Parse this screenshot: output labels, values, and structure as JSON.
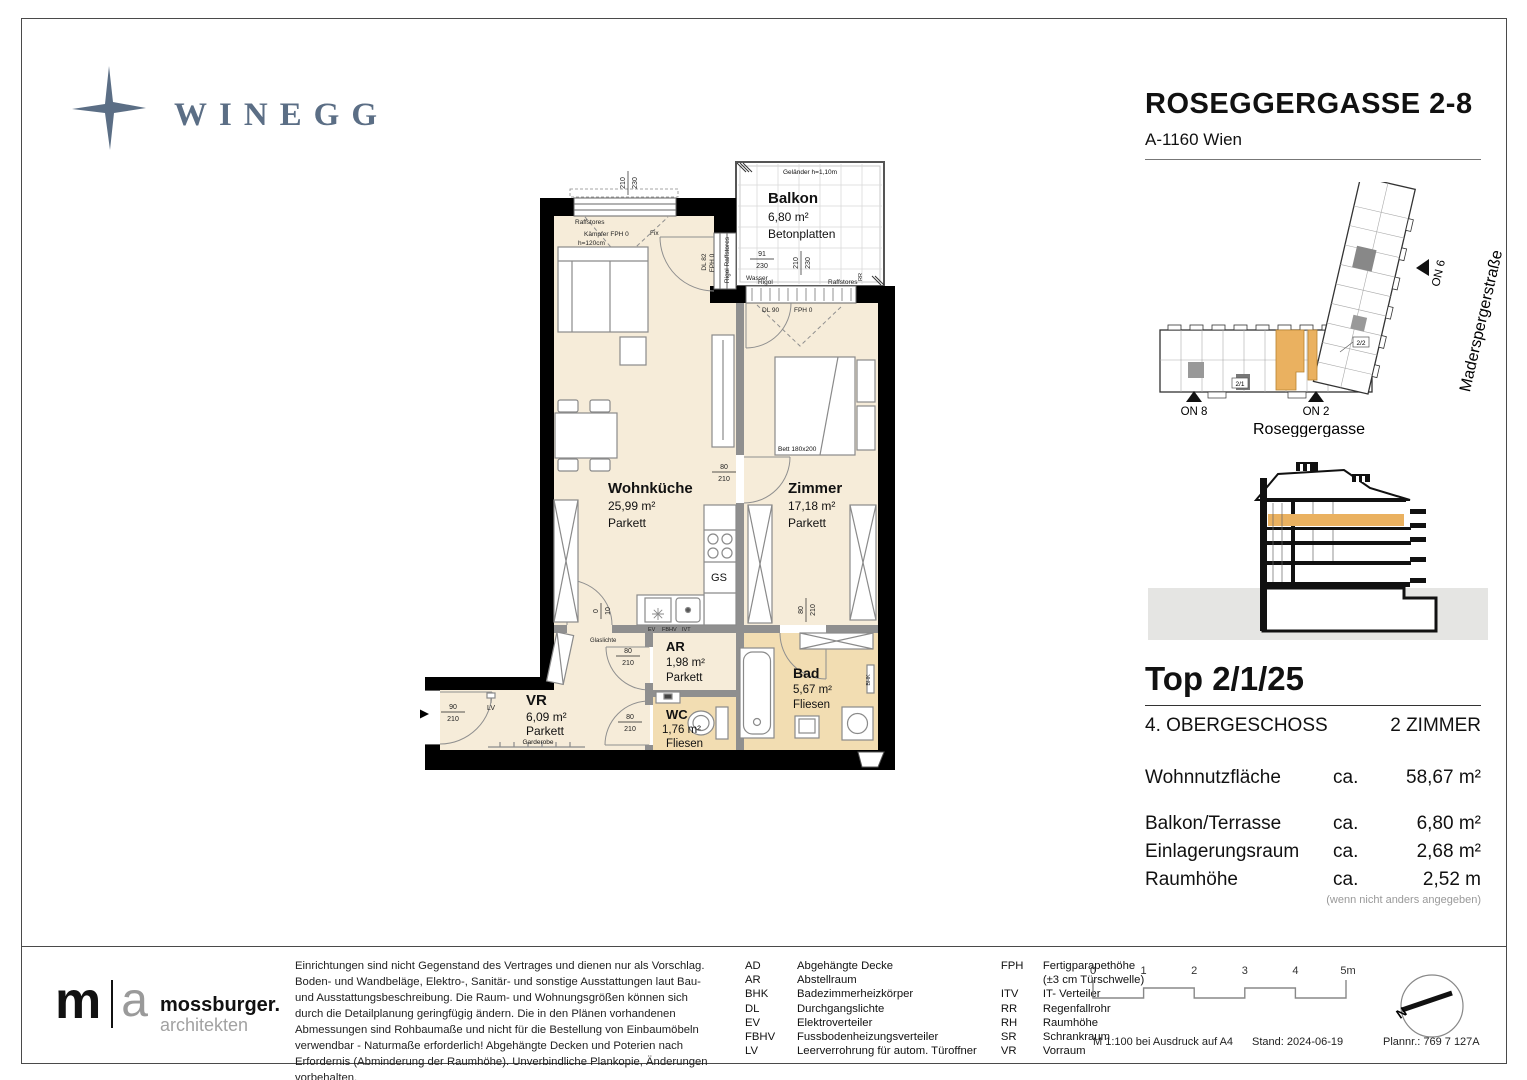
{
  "page": {
    "brand": "WINEGG",
    "title": "ROSEGGERGASSE 2-8",
    "subtitle": "A-1160 Wien"
  },
  "plan": {
    "rooms": {
      "balkon": {
        "name": "Balkon",
        "area": "6,80 m²",
        "floor": "Betonplatten",
        "railing": "Geländer h=1,10m"
      },
      "wohnkueche": {
        "name": "Wohnküche",
        "area": "25,99 m²",
        "floor": "Parkett"
      },
      "zimmer": {
        "name": "Zimmer",
        "area": "17,18 m²",
        "floor": "Parkett",
        "bed": "Bett 180x200"
      },
      "ar": {
        "name": "AR",
        "area": "1,98 m²",
        "floor": "Parkett"
      },
      "vr": {
        "name": "VR",
        "area": "6,09 m²",
        "floor": "Parkett",
        "wardrobe": "Garderobe"
      },
      "wc": {
        "name": "WC",
        "area": "1,76 m²",
        "floor": "Fliesen"
      },
      "bad": {
        "name": "Bad",
        "area": "5,67 m²",
        "floor": "Fliesen"
      }
    },
    "labels": {
      "unit": "2/1/25",
      "raffstores": "Raffstores",
      "kaempfer": "Kämpfer FPH 0",
      "h120": "h=120cm",
      "fix": "Fix",
      "dl82": "DL 82",
      "fph0": "FPH 0",
      "rigol_raffstores": "Rigol Raffstores",
      "wasser": "Wasser",
      "rigol": "Rigol",
      "dl90": "DL 90",
      "rr": "RR",
      "gs": "GS",
      "bhk": "BHK",
      "lv": "LV",
      "ev": "EV",
      "fbhv": "FBHV",
      "ivt": "IVT",
      "glaslichte": "Glaslichte"
    },
    "dims": {
      "v210": "210",
      "v230": "230",
      "v91": "91",
      "v80": "80",
      "v90": "90",
      "v0": "0",
      "v10": "10"
    }
  },
  "site": {
    "streets": {
      "roseggergasse": "Roseggergasse",
      "madersperger": "Maderspergerstraße"
    },
    "entrances": {
      "on8": "ON 8",
      "on2": "ON 2",
      "on6": "ON 6"
    },
    "units": {
      "u21": "2/1",
      "u22": "2/2"
    },
    "highlight_color": "#eab160"
  },
  "info": {
    "top": "Top 2/1/25",
    "floor": "4. OBERGESCHOSS",
    "rooms": "2 ZIMMER",
    "metrics": [
      {
        "label": "Wohnnutzfläche",
        "ca": "ca.",
        "value": "58,67 m²"
      },
      {
        "label": "Balkon/Terrasse",
        "ca": "ca.",
        "value": "6,80 m²"
      },
      {
        "label": "Einlagerungsraum",
        "ca": "ca.",
        "value": "2,68 m²"
      },
      {
        "label": "Raumhöhe",
        "ca": "ca.",
        "value": "2,52 m"
      }
    ],
    "note": "(wenn nicht anders angegeben)"
  },
  "footer": {
    "architect": {
      "m": "m",
      "a": "a",
      "name": "mossburger.",
      "sub": "architekten"
    },
    "disclaimer": "Einrichtungen sind nicht Gegenstand des Vertrages und dienen nur als Vorschlag. Boden- und Wandbeläge, Elektro-, Sanitär- und sonstige Ausstattungen laut Bau- und Ausstattungsbeschreibung. Die Raum- und Wohnungsgrößen können sich durch die Detailplanung geringfügig ändern. Die in den Plänen vorhandenen Abmessungen sind Rohbaumaße und nicht für die Bestellung von Einbaumöbeln verwendbar - Naturmaße erforderlich! Abgehängte Decken und Poterien nach Erfordernis (Abminderung der Raumhöhe). Unverbindliche Plankopie, Änderungen vorbehalten.",
    "legend": {
      "col1": [
        {
          "abbr": "AD",
          "name": "Abgehängte Decke"
        },
        {
          "abbr": "AR",
          "name": "Abstellraum"
        },
        {
          "abbr": "BHK",
          "name": "Badezimmerheizkörper"
        },
        {
          "abbr": "DL",
          "name": "Durchgangslichte"
        },
        {
          "abbr": "EV",
          "name": "Elektroverteiler"
        },
        {
          "abbr": "FBHV",
          "name": "Fussbodenheizungsverteiler"
        },
        {
          "abbr": "LV",
          "name": "Leerverrohrung für autom. Türoffner"
        }
      ],
      "col2": [
        {
          "abbr": "FPH",
          "name": "Fertigparapethöhe"
        },
        {
          "abbr": "",
          "name": "(±3 cm Türschwelle)"
        },
        {
          "abbr": "ITV",
          "name": "IT- Verteiler"
        },
        {
          "abbr": "RR",
          "name": "Regenfallrohr"
        },
        {
          "abbr": "RH",
          "name": "Raumhöhe"
        },
        {
          "abbr": "SR",
          "name": "Schrankraum"
        },
        {
          "abbr": "VR",
          "name": "Vorraum"
        }
      ]
    },
    "scalebar": {
      "ticks": [
        "0",
        "1",
        "2",
        "3",
        "4",
        "5m"
      ]
    },
    "print": {
      "scale": "M 1:100 bei Ausdruck auf A4",
      "stand": "Stand: 2024-06-19",
      "plannr": "Plannr.: 769 7 127A"
    },
    "north": "N"
  }
}
